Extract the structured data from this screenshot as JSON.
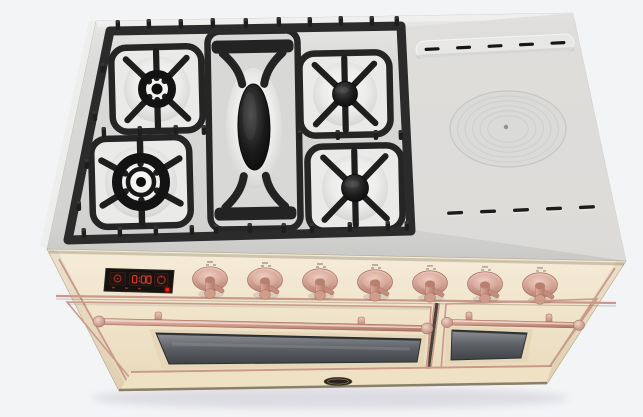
{
  "meta": {
    "subject": "Freestanding dual-fuel range cooker, cream body with copper trim, three-quarter top-front product render",
    "background": "plain light studio backdrop"
  },
  "palette": {
    "background": "#f3f4f6",
    "cooktop_steel": "#d8d9d7",
    "cooktop_highlight": "#eceeec",
    "grate_iron": "#2a2a2a",
    "burner_well": "#efefed",
    "body_cream": "#f1e7d1",
    "body_cream_shade": "#e7d7ba",
    "copper_trim": "#cf9e92",
    "copper_deep": "#a87462",
    "oven_glass": "#5c6064",
    "display_background": "#15120f",
    "display_red": "#e0392b",
    "power_light_red": "#ff2012",
    "badge_black": "#2a241f"
  },
  "cooktop": {
    "gas_section": {
      "burners": [
        {
          "id": "rear-left",
          "type": "open-ring-burner"
        },
        {
          "id": "front-left",
          "type": "large-ring-burner"
        },
        {
          "id": "rear-right",
          "type": "capped-burner"
        },
        {
          "id": "front-right",
          "type": "capped-burner"
        }
      ],
      "griddle_burner": {
        "id": "center-oval-burner",
        "type": "elongated-oval"
      }
    },
    "solid_section": {
      "simmer_plate": {
        "rings": 6
      },
      "vent_slots_back": 5,
      "vent_slots_front": 5
    }
  },
  "control_panel": {
    "display": {
      "zones": [
        "oven-function-icon",
        "clock-digits",
        "timer-dial-icon"
      ],
      "clock_reading": "0:00",
      "indicator_marks": 3,
      "power_light": true
    },
    "knobs": [
      {
        "id": "knob-1"
      },
      {
        "id": "knob-2"
      },
      {
        "id": "knob-3"
      },
      {
        "id": "knob-4"
      },
      {
        "id": "knob-5"
      },
      {
        "id": "knob-6"
      },
      {
        "id": "knob-7"
      }
    ]
  },
  "doors": {
    "left_oven": {
      "handle": "copper-bar-handle",
      "window": "dark-glass"
    },
    "right_oven": {
      "handle": "copper-bar-handle",
      "window": "dark-glass"
    }
  },
  "base": {
    "brand_badge": "dark-oval-emblem"
  }
}
